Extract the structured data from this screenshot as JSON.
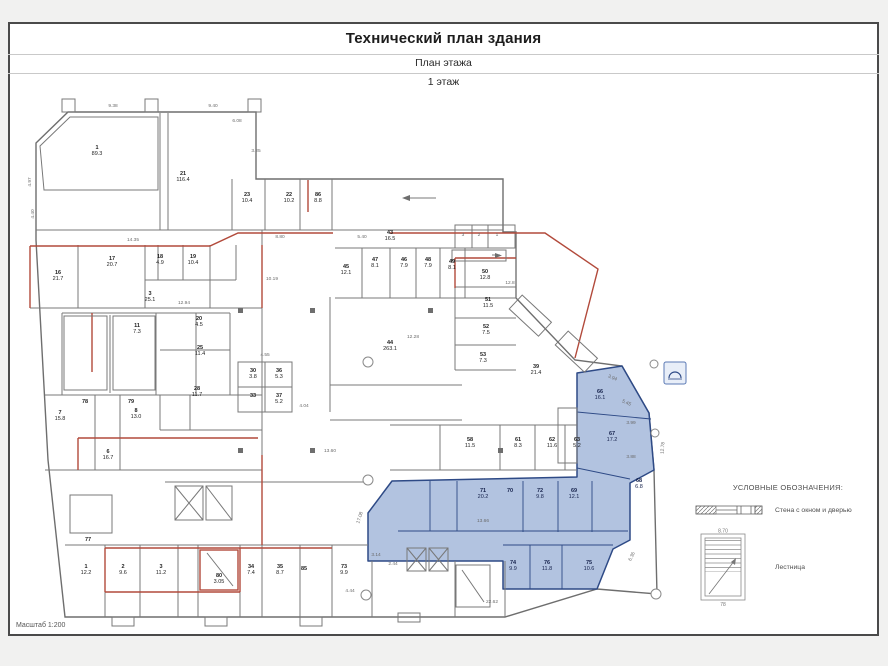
{
  "page": {
    "title": "Технический план здания",
    "subtitle": "План этажа",
    "floor_label": "1 этаж",
    "scale_label": "Масштаб 1:200"
  },
  "legend": {
    "heading": "УСЛОВНЫЕ ОБОЗНАЧЕНИЯ:",
    "items": [
      {
        "name": "wall-with-window-and-door",
        "label": "Стена с окном и дверью"
      },
      {
        "name": "stairs",
        "label": "Лестница"
      }
    ],
    "stairs_top_dim": "8.70",
    "stairs_bottom_label": "78"
  },
  "plan": {
    "colors": {
      "wall": "#787878",
      "red_wall": "#b24a3b",
      "highlight_fill": "#abbedd",
      "highlight_stroke": "#2e4a86"
    },
    "rooms": [
      {
        "n": "1",
        "a": "89.3",
        "x": 97,
        "y": 149
      },
      {
        "n": "21",
        "a": "116.4",
        "x": 183,
        "y": 175
      },
      {
        "n": "23",
        "a": "10.4",
        "x": 247,
        "y": 196
      },
      {
        "n": "22",
        "a": "10.2",
        "x": 289,
        "y": 196
      },
      {
        "n": "86",
        "a": "8.8",
        "x": 318,
        "y": 196
      },
      {
        "n": "16",
        "a": "21.7",
        "x": 58,
        "y": 274
      },
      {
        "n": "17",
        "a": "20.7",
        "x": 112,
        "y": 260
      },
      {
        "n": "18",
        "a": "4.9",
        "x": 160,
        "y": 258
      },
      {
        "n": "19",
        "a": "10.4",
        "x": 193,
        "y": 258
      },
      {
        "n": "3",
        "a": "25.1",
        "x": 150,
        "y": 295
      },
      {
        "n": "11",
        "a": "7.3",
        "x": 137,
        "y": 327
      },
      {
        "n": "20",
        "a": "4.5",
        "x": 199,
        "y": 320
      },
      {
        "n": "25",
        "a": "11.4",
        "x": 200,
        "y": 349
      },
      {
        "n": "28",
        "a": "11.7",
        "x": 197,
        "y": 390
      },
      {
        "n": "78",
        "a": "",
        "x": 85,
        "y": 403
      },
      {
        "n": "79",
        "a": "",
        "x": 131,
        "y": 403
      },
      {
        "n": "7",
        "a": "15.8",
        "x": 60,
        "y": 414
      },
      {
        "n": "8",
        "a": "13.0",
        "x": 136,
        "y": 412
      },
      {
        "n": "6",
        "a": "16.7",
        "x": 108,
        "y": 453
      },
      {
        "n": "77",
        "a": "",
        "x": 88,
        "y": 541
      },
      {
        "n": "1",
        "a": "12.2",
        "x": 86,
        "y": 568
      },
      {
        "n": "2",
        "a": "9.6",
        "x": 123,
        "y": 568
      },
      {
        "n": "3",
        "a": "11.2",
        "x": 161,
        "y": 568
      },
      {
        "n": "80",
        "a": "3.05",
        "x": 219,
        "y": 577
      },
      {
        "n": "34",
        "a": "7.4",
        "x": 251,
        "y": 568
      },
      {
        "n": "35",
        "a": "8.7",
        "x": 280,
        "y": 568
      },
      {
        "n": "85",
        "a": "",
        "x": 304,
        "y": 570
      },
      {
        "n": "73",
        "a": "9.9",
        "x": 344,
        "y": 568
      },
      {
        "n": "44",
        "a": "263.1",
        "x": 390,
        "y": 344
      },
      {
        "n": "43",
        "a": "16.5",
        "x": 390,
        "y": 234
      },
      {
        "n": "45",
        "a": "12.1",
        "x": 346,
        "y": 268
      },
      {
        "n": "47",
        "a": "8.1",
        "x": 375,
        "y": 261
      },
      {
        "n": "46",
        "a": "7.9",
        "x": 404,
        "y": 261
      },
      {
        "n": "48",
        "a": "7.9",
        "x": 428,
        "y": 261
      },
      {
        "n": "49",
        "a": "8.1",
        "x": 452,
        "y": 263
      },
      {
        "n": "50",
        "a": "12.8",
        "x": 485,
        "y": 273
      },
      {
        "n": "51",
        "a": "11.5",
        "x": 488,
        "y": 301
      },
      {
        "n": "52",
        "a": "7.5",
        "x": 486,
        "y": 328
      },
      {
        "n": "53",
        "a": "7.3",
        "x": 483,
        "y": 356
      },
      {
        "n": "39",
        "a": "21.4",
        "x": 536,
        "y": 368
      },
      {
        "n": "30",
        "a": "3.8",
        "x": 253,
        "y": 372
      },
      {
        "n": "36",
        "a": "5.3",
        "x": 279,
        "y": 372
      },
      {
        "n": "33",
        "a": "",
        "x": 253,
        "y": 397
      },
      {
        "n": "37",
        "a": "5.2",
        "x": 279,
        "y": 397
      },
      {
        "n": "58",
        "a": "11.5",
        "x": 470,
        "y": 441
      },
      {
        "n": "61",
        "a": "8.3",
        "x": 518,
        "y": 441
      },
      {
        "n": "62",
        "a": "11.6",
        "x": 552,
        "y": 441
      },
      {
        "n": "63",
        "a": "5.2",
        "x": 577,
        "y": 441
      },
      {
        "n": "66",
        "a": "16.1",
        "x": 600,
        "y": 393,
        "hl": 1
      },
      {
        "n": "67",
        "a": "17.2",
        "x": 612,
        "y": 435,
        "hl": 1
      },
      {
        "n": "68",
        "a": "6.8",
        "x": 639,
        "y": 482,
        "hl": 1
      },
      {
        "n": "71",
        "a": "20.2",
        "x": 483,
        "y": 492,
        "hl": 1
      },
      {
        "n": "70",
        "a": "",
        "x": 510,
        "y": 492,
        "hl": 1
      },
      {
        "n": "72",
        "a": "9.8",
        "x": 540,
        "y": 492,
        "hl": 1
      },
      {
        "n": "69",
        "a": "12.1",
        "x": 574,
        "y": 492,
        "hl": 1
      },
      {
        "n": "74",
        "a": "9.9",
        "x": 513,
        "y": 564,
        "hl": 1
      },
      {
        "n": "76",
        "a": "11.8",
        "x": 547,
        "y": 564,
        "hl": 1
      },
      {
        "n": "75",
        "a": "10.6",
        "x": 589,
        "y": 564,
        "hl": 1
      }
    ],
    "dims": [
      {
        "t": "9.38",
        "x": 113,
        "y": 107
      },
      {
        "t": "9.40",
        "x": 213,
        "y": 107
      },
      {
        "t": "6.08",
        "x": 237,
        "y": 122
      },
      {
        "t": "3.25",
        "x": 256,
        "y": 152
      },
      {
        "t": "4.97",
        "x": 31,
        "y": 182,
        "rot": -90
      },
      {
        "t": "4.40",
        "x": 34,
        "y": 214,
        "rot": -90
      },
      {
        "t": "14.35",
        "x": 133,
        "y": 241
      },
      {
        "t": "12.94",
        "x": 184,
        "y": 304
      },
      {
        "t": "8.80",
        "x": 280,
        "y": 238
      },
      {
        "t": "5.40",
        "x": 362,
        "y": 238
      },
      {
        "t": "10.19",
        "x": 272,
        "y": 280
      },
      {
        "t": "12.28",
        "x": 413,
        "y": 338
      },
      {
        "t": "4.55",
        "x": 265,
        "y": 356
      },
      {
        "t": "4.04",
        "x": 304,
        "y": 407
      },
      {
        "t": "13.60",
        "x": 330,
        "y": 452
      },
      {
        "t": "13.66",
        "x": 483,
        "y": 522
      },
      {
        "t": "17.08",
        "x": 361,
        "y": 518,
        "rot": -72
      },
      {
        "t": "3.14",
        "x": 376,
        "y": 556
      },
      {
        "t": "2.44",
        "x": 393,
        "y": 565
      },
      {
        "t": "4.44",
        "x": 350,
        "y": 592
      },
      {
        "t": "22.62",
        "x": 492,
        "y": 603
      },
      {
        "t": "3.94",
        "x": 612,
        "y": 379,
        "rot": 24
      },
      {
        "t": "5.45",
        "x": 626,
        "y": 404,
        "rot": 24
      },
      {
        "t": "3.99",
        "x": 631,
        "y": 424
      },
      {
        "t": "3.88",
        "x": 631,
        "y": 458
      },
      {
        "t": "12.78",
        "x": 664,
        "y": 448,
        "rot": -86
      },
      {
        "t": "6.36",
        "x": 633,
        "y": 557,
        "rot": -65
      },
      {
        "t": "3",
        "x": 463,
        "y": 236
      },
      {
        "t": "2",
        "x": 479,
        "y": 236
      },
      {
        "t": "1",
        "x": 497,
        "y": 236
      },
      {
        "t": "12.8",
        "x": 510,
        "y": 284
      }
    ]
  }
}
